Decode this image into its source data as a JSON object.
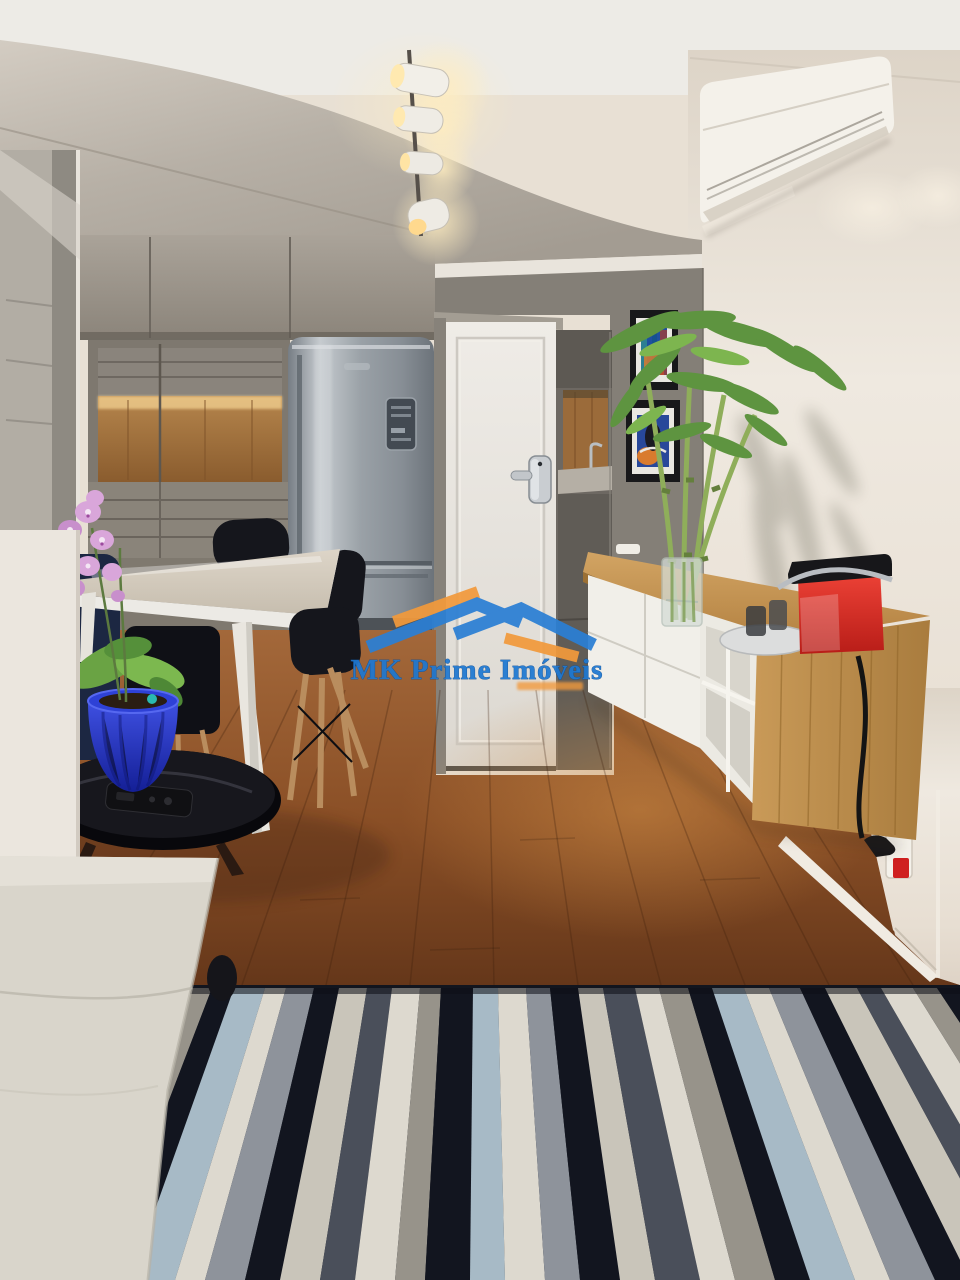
{
  "meta": {
    "domain": "Natural-Image",
    "description": "Real-estate interior photograph: open-plan kitchen, dining and living area of a small modern apartment with wood floor and striped rug",
    "width_px": 960,
    "height_px": 1280
  },
  "watermark": {
    "brand": "MK Prime Imóveis",
    "brand_color": "#1e78d2",
    "roof_blue": "#2b7fd4",
    "roof_orange": "#f29a3c",
    "tagline": {
      "visible": true,
      "legible": false,
      "color": "#f29a3c"
    }
  },
  "scene": {
    "room": "kitchen-dining-living open plan",
    "objects": [
      {
        "name": "track-spotlights",
        "label": "Ceiling track with four white spotlights"
      },
      {
        "name": "air-conditioner",
        "label": "White split air-conditioner unit, upper right wall"
      },
      {
        "name": "kitchen-cabinets",
        "label": "Gray matte cabinetry wall with lit oak niche"
      },
      {
        "name": "refrigerator",
        "label": "Stainless steel bottom-freezer refrigerator"
      },
      {
        "name": "entry-door",
        "label": "White entry door with silver electronic lock"
      },
      {
        "name": "kitchenette",
        "label": "Gray counter nook with oak backsplash and faucet"
      },
      {
        "name": "artworks",
        "label": "Two framed colorful abstract prints on gray wall"
      },
      {
        "name": "bamboo-plant",
        "label": "Lucky bamboo stalks in a glass vase"
      },
      {
        "name": "sideboard",
        "label": "Floating white sideboard with bamboo wood top and side"
      },
      {
        "name": "espresso-machine",
        "label": "Red and black capsule espresso machine on tray"
      },
      {
        "name": "power-outlet",
        "label": "Wall outlet with black plug and red tag"
      },
      {
        "name": "dining-table",
        "label": "White dining table with splayed legs"
      },
      {
        "name": "dining-chairs",
        "label": "Black shell chairs with wooden legs"
      },
      {
        "name": "orchid",
        "label": "Pink orchid in cobalt blue fluted pot"
      },
      {
        "name": "side-table",
        "label": "Round black gloss side table with remote control"
      },
      {
        "name": "sofa",
        "label": "Light beige fabric sofa corner, foreground left"
      },
      {
        "name": "rug",
        "label": "Striped rug in navy, gray, light blue and cream"
      },
      {
        "name": "wood-floor",
        "label": "Warm brown hardwood plank floor"
      }
    ],
    "palette": {
      "ceiling_white": "#edebe6",
      "soffit_gray": "#b3aca2",
      "cabinet_gray": "#968f85",
      "oak_wood": "#a4763f",
      "stainless": "#9aa1a7",
      "door_white": "#e9e6e0",
      "wall_warm_white": "#ece5da",
      "art_wall_gray": "#847f77",
      "floor_brown": "#8a4f26",
      "rug_navy": "#12151f",
      "rug_blue": "#a7bac6",
      "rug_cream": "#ddd9cf",
      "sofa_beige": "#d9d5cb",
      "pot_cobalt": "#2c3fd0",
      "machine_red": "#e23128"
    }
  }
}
